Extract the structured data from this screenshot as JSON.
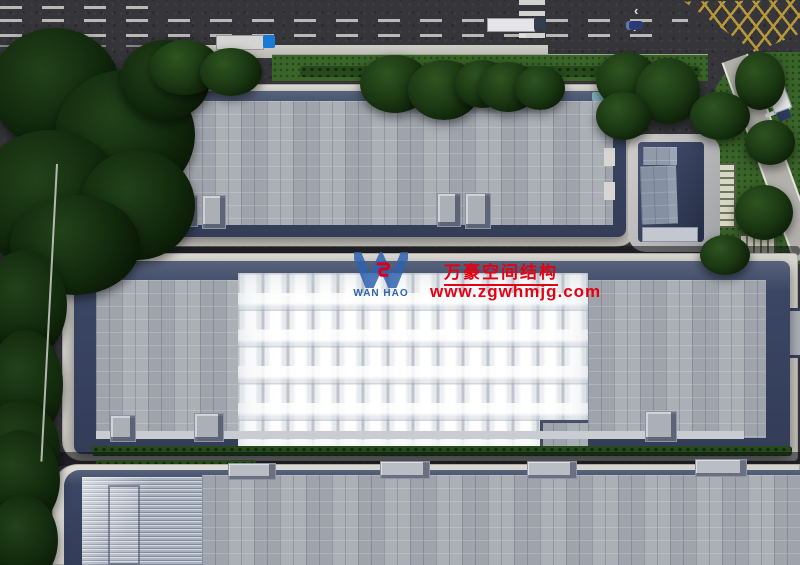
{
  "watermark": {
    "logo_text": "WAN HAO",
    "company_name_cn": "万豪空间结构",
    "website": "www.zgwhmjg.com",
    "logo_blue": "#2f62ae",
    "accent_red": "#e60012"
  },
  "scene": {
    "palette": {
      "asphalt": "#36353a",
      "roof_panels": "#a6aab1",
      "parapet_navy": "#333d58",
      "membrane_white": "#f2f3f5",
      "grass": "#3a6429",
      "apron_concrete": "#d3d1cc",
      "marking_white": "#dadad6",
      "junction_yellow": "#c2a03a",
      "truck_cab_blue": "#1b79d6",
      "logo_blue": "#2f62ae",
      "accent_red": "#e60012"
    },
    "membrane": {
      "columns": 14,
      "rows": 5
    }
  }
}
